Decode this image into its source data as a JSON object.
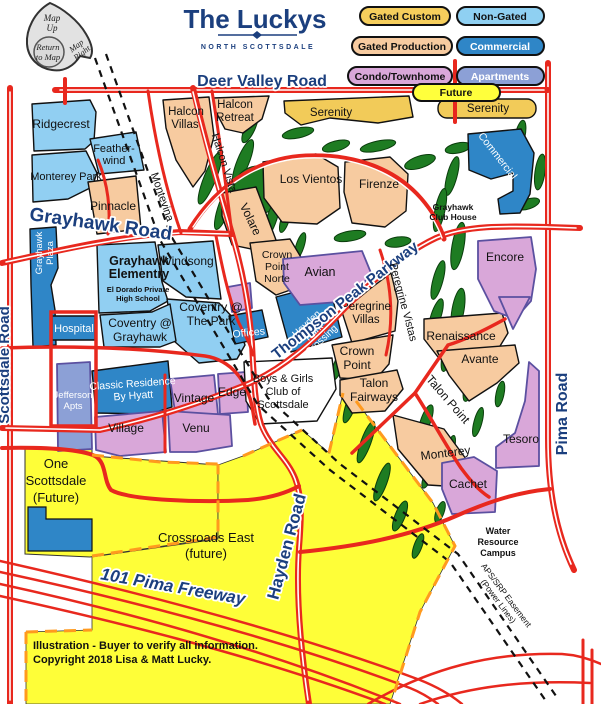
{
  "colors": {
    "navy": "#1B3F7E",
    "road_red": "#E8281E",
    "non_gated": "#91CFF2",
    "commercial": "#2F86C7",
    "gated_production": "#F7CBA0",
    "gated_custom": "#F2CB59",
    "condo": "#D9A7D9",
    "apartments": "#8CA0D6",
    "future": "#FEFE38",
    "golf_green": "#1E7C22",
    "boundary_orange": "#FF9A1E"
  },
  "header": {
    "title": "The Luckys",
    "subtitle": "NORTH SCOTTSDALE"
  },
  "nav": {
    "up1": "Map",
    "up2": "Up",
    "ret1": "Return",
    "ret2": "to Map",
    "right1": "Map",
    "right2": "Right"
  },
  "legend": [
    {
      "label": "Gated Custom",
      "color": "#F6CE5C"
    },
    {
      "label": "Non-Gated",
      "color": "#8FD0F2"
    },
    {
      "label": "Gated Production",
      "color": "#F7CBA0"
    },
    {
      "label": "Commercial",
      "color": "#2F86C7"
    },
    {
      "label": "Condo/Townhome",
      "color": "#D9A7D9"
    },
    {
      "label": "Apartments",
      "color": "#8CA0D6"
    },
    {
      "label": "Future",
      "color": "#FFFF3C"
    }
  ],
  "roads": {
    "deer_valley": "Deer Valley Road",
    "grayhawk": "Grayhawk Road",
    "scottsdale": "Scottsdale Road",
    "pima": "Pima Road",
    "hayden": "Hayden Road",
    "thompson": "Thompson Peak Parkway",
    "freeway": "101 Pima Freeway",
    "montevina": "Montevina",
    "halcon_vista": "Halcon Vista",
    "peregrine_vistas": "Peregrine Vistas",
    "talon_point": "Talon Point",
    "easement1": "APS/SRP Easement",
    "easement2": "(Power Lines)"
  },
  "nb": {
    "ridgecrest": [
      "Ridgecrest"
    ],
    "featherwind": [
      "Feather-",
      "wind"
    ],
    "monterey_park": [
      "Monterey Park"
    ],
    "pinnacle": [
      "Pinnacle"
    ],
    "halcon_villas": [
      "Halcon",
      "Villas"
    ],
    "halcon_retreat": [
      "Halcon",
      "Retreat"
    ],
    "serenity_n": [
      "Serenity"
    ],
    "serenity_e": [
      "Serenity"
    ],
    "los_vientos": [
      "Los Vientos"
    ],
    "firenze": [
      "Firenze"
    ],
    "volare": [
      "Volare"
    ],
    "windsong": [
      "Windsong"
    ],
    "grayhawk_elementry": [
      "Grayhawk",
      "Elementry"
    ],
    "el_dorado": [
      "El Dorado Private",
      "High School"
    ],
    "coventry_park": [
      "Coventry @",
      "The Park"
    ],
    "coventry_grayhawk": [
      "Coventry @",
      "Grayhawk"
    ],
    "grayhawk_plaza": [
      "Grayhawk",
      "Plaza"
    ],
    "hospital": [
      "Hospital"
    ],
    "offices": [
      "Offices"
    ],
    "crown_point_norte": [
      "Crown",
      "Point",
      "Norte"
    ],
    "avian": [
      "Avian"
    ],
    "encore": [
      "Encore"
    ],
    "commercial": [
      "Commercial"
    ],
    "peregrine_villas": [
      "Peregrine",
      "Villas"
    ],
    "hayden_park": [
      "Hayden",
      "Park",
      "Crossing"
    ],
    "crown_point": [
      "Crown",
      "Point"
    ],
    "talon_fairways": [
      "Talon",
      "Fairways"
    ],
    "renaissance": [
      "Renaissance"
    ],
    "avante": [
      "Avante"
    ],
    "classic_residence": [
      "Classic Residence",
      "By Hyatt"
    ],
    "jefferson": [
      "Jefferson",
      "Apts"
    ],
    "vintage": [
      "Vintage"
    ],
    "edge": [
      "Edge"
    ],
    "village": [
      "Village"
    ],
    "venu": [
      "Venu"
    ],
    "boys_girls": [
      "Boys & Girls",
      "Club of",
      "Scottsdale"
    ],
    "monterey": [
      "Monterey"
    ],
    "tesoro": [
      "Tesoro"
    ],
    "cachet": [
      "Cachet"
    ],
    "one_scottsdale": [
      "One",
      "Scottsdale",
      "(Future)"
    ],
    "crossroads": [
      "Crossroads East",
      "(future)"
    ],
    "water": [
      "Water",
      "Resource",
      "Campus"
    ],
    "club_house": [
      "Grayhawk",
      "Club House"
    ]
  },
  "footer": {
    "line1": "Illustration - Buyer to verify all information.",
    "line2": "Copyright 2018 Lisa & Matt Lucky."
  }
}
